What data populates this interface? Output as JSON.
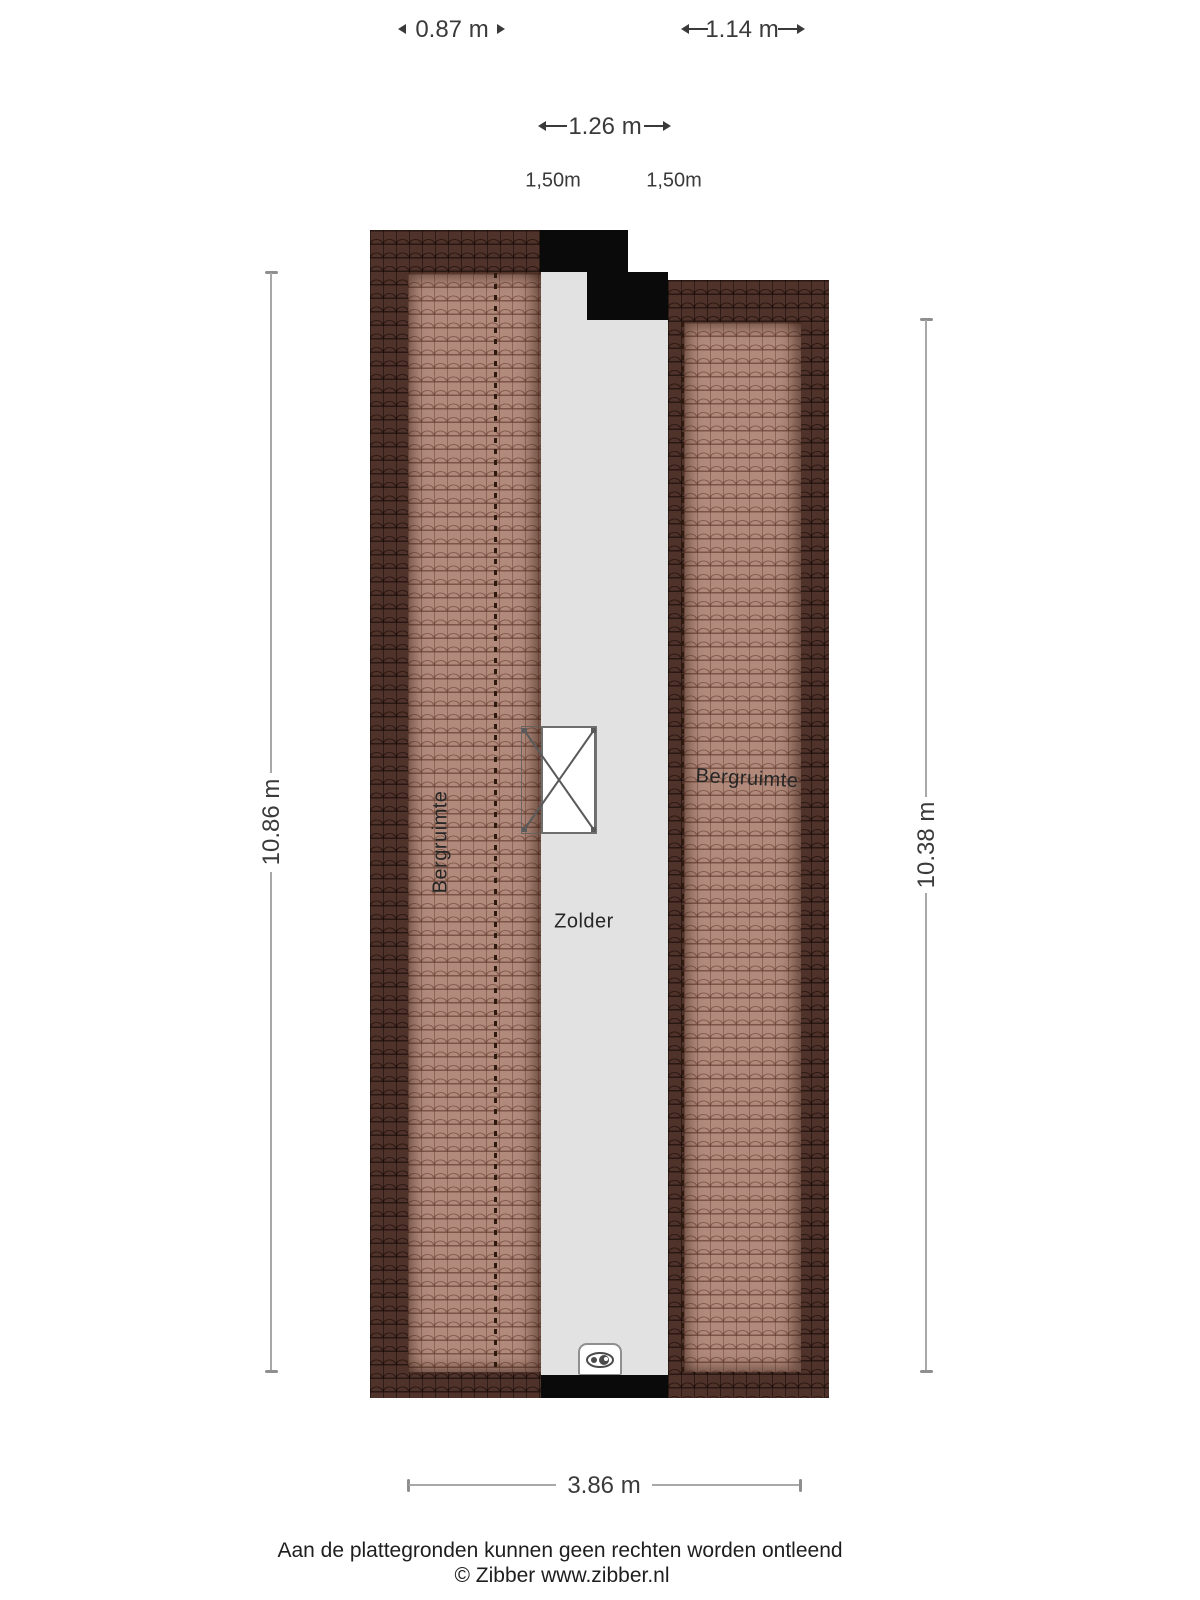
{
  "plan_title": "Zolder floor plan",
  "dimensions": {
    "top_small": {
      "label": "0.87 m"
    },
    "top_right": {
      "label": "1.14 m"
    },
    "mid": {
      "label": "1.26 m"
    },
    "height_line_left": {
      "label": "1,50m"
    },
    "height_line_right": {
      "label": "1,50m"
    },
    "left": {
      "label": "10.86 m"
    },
    "right": {
      "label": "10.38 m"
    },
    "bottom": {
      "label": "3.86 m"
    }
  },
  "rooms": {
    "left": "Bergruimte",
    "right": "Bergruimte",
    "center": "Zolder"
  },
  "icons": {
    "stairs_opening": "stairs-opening-icon",
    "ventilation": "ventilation-unit-icon"
  },
  "footer": {
    "disclaimer": "Aan de plattegronden kunnen geen rechten worden ontleend",
    "credit": "© Zibber www.zibber.nl"
  },
  "colors": {
    "roof_dark": "#4f322a",
    "roof_light": "#b18a7c",
    "floor_gray": "#e2e2e2",
    "wall_black": "#0a0a0a",
    "dimension_line": "#a8a8a8",
    "text": "#3a3a3a"
  }
}
